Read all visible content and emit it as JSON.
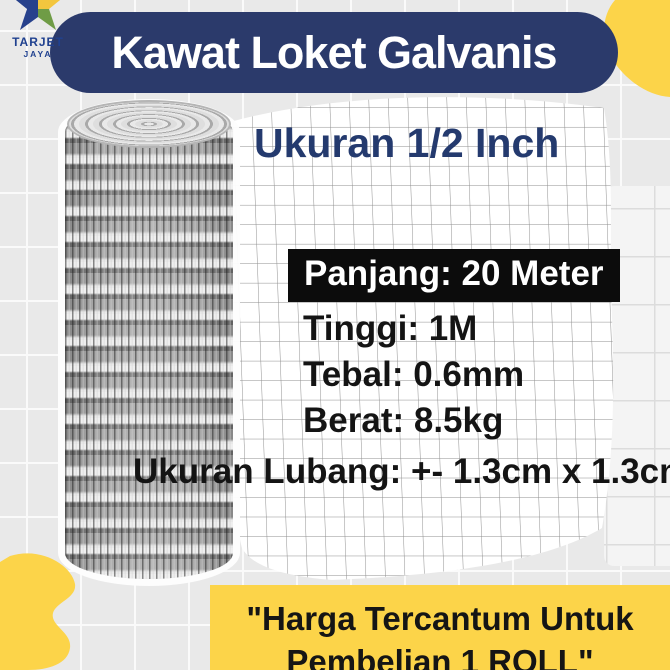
{
  "brand": {
    "name": "TARJET",
    "subname": "JAYA"
  },
  "header": {
    "title": "Kawat Loket Galvanis",
    "subtitle": "Ukuran 1/2 Inch"
  },
  "specs": {
    "highlight": "Panjang: 20 Meter",
    "lines": [
      "Tinggi: 1M",
      "Tebal: 0.6mm",
      "Berat: 8.5kg"
    ],
    "hole_size": "Ukuran Lubang: +- 1.3cm x 1.3cm"
  },
  "footer": {
    "line1": "\"Harga Tercantum Untuk",
    "line2": "Pembelian 1 ROLL\""
  },
  "product_image": "galvanized-wire-mesh-roll",
  "colors": {
    "navy": "#2b3a6b",
    "brand_blue": "#20418f",
    "yellow": "#fcd449",
    "black_box": "#0c0c0c",
    "background": "#e9e9e9"
  }
}
